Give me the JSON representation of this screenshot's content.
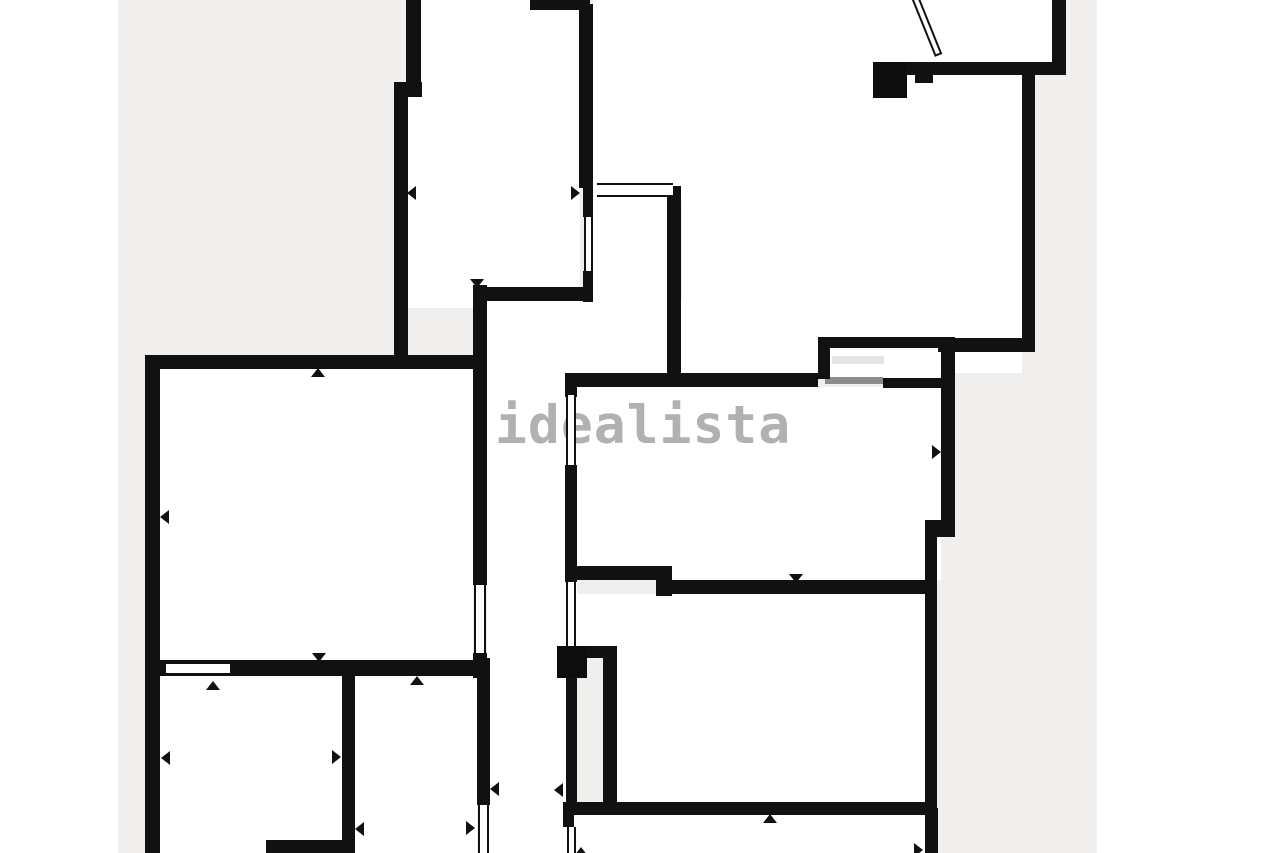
{
  "watermark": {
    "text": "idealista",
    "color": "#b3b1af",
    "x": 495,
    "y": 399
  },
  "canvas": {
    "width": 1280,
    "height": 853,
    "margin_color": "#ffffff",
    "field_color": "#f1efed",
    "wall_color": "#111111",
    "room_color": "#ffffff",
    "field": [
      118,
      0,
      979,
      853
    ]
  },
  "plan": {
    "rooms": [
      [
        408,
        0,
        172,
        290
      ],
      [
        408,
        288,
        66,
        20
      ],
      [
        487,
        285,
        90,
        568
      ],
      [
        565,
        301,
        117,
        72
      ],
      [
        593,
        0,
        459,
        70
      ],
      [
        682,
        70,
        340,
        303
      ],
      [
        593,
        70,
        89,
        131
      ],
      [
        593,
        197,
        75,
        106
      ],
      [
        577,
        387,
        364,
        193
      ],
      [
        577,
        594,
        348,
        208
      ],
      [
        577,
        815,
        348,
        38
      ],
      [
        159,
        369,
        314,
        291
      ],
      [
        159,
        676,
        183,
        177
      ],
      [
        355,
        676,
        122,
        177
      ]
    ],
    "walls": [
      [
        406,
        0,
        15,
        90
      ],
      [
        394,
        82,
        28,
        15
      ],
      [
        394,
        84,
        14,
        274
      ],
      [
        530,
        0,
        60,
        10
      ],
      [
        579,
        4,
        14,
        184
      ],
      [
        583,
        186,
        10,
        31
      ],
      [
        583,
        271,
        10,
        31
      ],
      [
        473,
        287,
        116,
        14
      ],
      [
        667,
        186,
        14,
        194
      ],
      [
        905,
        62,
        28,
        13
      ],
      [
        915,
        69,
        18,
        14
      ],
      [
        928,
        62,
        138,
        13
      ],
      [
        1052,
        0,
        14,
        68
      ],
      [
        1022,
        64,
        13,
        281
      ],
      [
        938,
        338,
        97,
        14
      ],
      [
        818,
        337,
        134,
        11
      ],
      [
        818,
        337,
        12,
        42
      ],
      [
        883,
        378,
        58,
        10
      ],
      [
        941,
        337,
        14,
        200
      ],
      [
        925,
        520,
        30,
        17
      ],
      [
        925,
        537,
        12,
        271
      ],
      [
        925,
        808,
        13,
        45
      ],
      [
        565,
        373,
        253,
        14
      ],
      [
        565,
        373,
        12,
        24
      ],
      [
        565,
        465,
        12,
        117
      ],
      [
        566,
        678,
        11,
        126
      ],
      [
        563,
        802,
        374,
        13
      ],
      [
        563,
        815,
        11,
        12
      ],
      [
        603,
        646,
        14,
        158
      ],
      [
        587,
        646,
        20,
        12
      ],
      [
        570,
        566,
        100,
        14
      ],
      [
        656,
        566,
        16,
        30
      ],
      [
        668,
        580,
        257,
        14
      ],
      [
        145,
        355,
        342,
        14
      ],
      [
        145,
        355,
        15,
        498
      ],
      [
        473,
        285,
        14,
        300
      ],
      [
        473,
        653,
        14,
        25
      ],
      [
        145,
        660,
        342,
        16
      ],
      [
        342,
        676,
        13,
        168
      ],
      [
        266,
        840,
        89,
        13
      ],
      [
        477,
        658,
        13,
        147
      ]
    ],
    "windows_v": [
      [
        584,
        217,
        9,
        54
      ],
      [
        566,
        395,
        10,
        70
      ],
      [
        566,
        582,
        10,
        64
      ],
      [
        474,
        585,
        12,
        68
      ],
      [
        567,
        827,
        9,
        26
      ],
      [
        478,
        805,
        11,
        48
      ]
    ],
    "windows_h": [
      [
        597,
        183,
        76,
        14
      ],
      [
        166,
        662,
        64,
        13
      ]
    ],
    "solids": [
      [
        873,
        62,
        34,
        36
      ],
      [
        557,
        646,
        30,
        32
      ]
    ],
    "patches": [
      [
        573,
        658,
        31,
        144
      ]
    ],
    "balcony": {
      "interior": [
        830,
        348,
        110,
        30
      ],
      "glass": [
        832,
        356,
        52,
        8
      ],
      "edge": [
        825,
        377,
        58,
        7
      ]
    },
    "arrows": [
      [
        "left",
        412,
        193
      ],
      [
        "right",
        575,
        193
      ],
      [
        "down",
        477,
        283
      ],
      [
        "up",
        318,
        373
      ],
      [
        "left",
        165,
        517
      ],
      [
        "right",
        479,
        517
      ],
      [
        "down",
        319,
        657
      ],
      [
        "up",
        213,
        686
      ],
      [
        "left",
        166,
        758
      ],
      [
        "right",
        336,
        757
      ],
      [
        "up",
        417,
        681
      ],
      [
        "left",
        360,
        829
      ],
      [
        "right",
        470,
        828
      ],
      [
        "left",
        495,
        789
      ],
      [
        "right",
        936,
        452
      ],
      [
        "down",
        796,
        578
      ],
      [
        "up",
        770,
        819
      ],
      [
        "left",
        559,
        790
      ],
      [
        "right",
        918,
        850
      ],
      [
        "up",
        581,
        852
      ]
    ],
    "door_swing": {
      "x": 911,
      "y": -3,
      "w": 8,
      "h": 63,
      "angle": -22
    }
  }
}
